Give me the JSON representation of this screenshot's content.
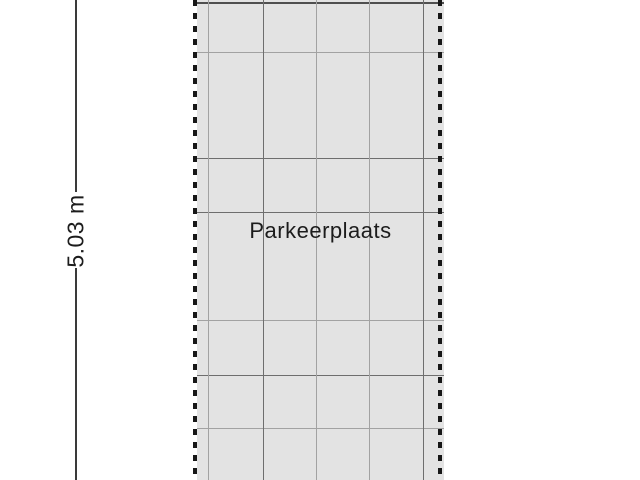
{
  "floorplan": {
    "room_label": "Parkeerplaats",
    "dimension_label": "5.03 m"
  },
  "colors": {
    "background": "#ffffff",
    "area_fill": "#e3e3e3",
    "grid_line_light": "#a2a2a2",
    "grid_line_dark": "#6e6e6e",
    "area_top_edge": "#4f4f4f",
    "boundary_dash": "#171717",
    "dimension_line": "#3a3a3a",
    "text": "#1c1c1c"
  },
  "grid": {
    "h_lines": [
      {
        "y": 2,
        "shade": "edge"
      },
      {
        "y": 52,
        "shade": "light"
      },
      {
        "y": 158,
        "shade": "dark"
      },
      {
        "y": 212,
        "shade": "dark"
      },
      {
        "y": 320,
        "shade": "light"
      },
      {
        "y": 375,
        "shade": "dark"
      },
      {
        "y": 428,
        "shade": "light"
      }
    ],
    "v_lines": [
      {
        "x": 11,
        "shade": "light"
      },
      {
        "x": 66,
        "shade": "dark"
      },
      {
        "x": 119,
        "shade": "light"
      },
      {
        "x": 172,
        "shade": "light"
      },
      {
        "x": 226,
        "shade": "dark"
      }
    ]
  }
}
